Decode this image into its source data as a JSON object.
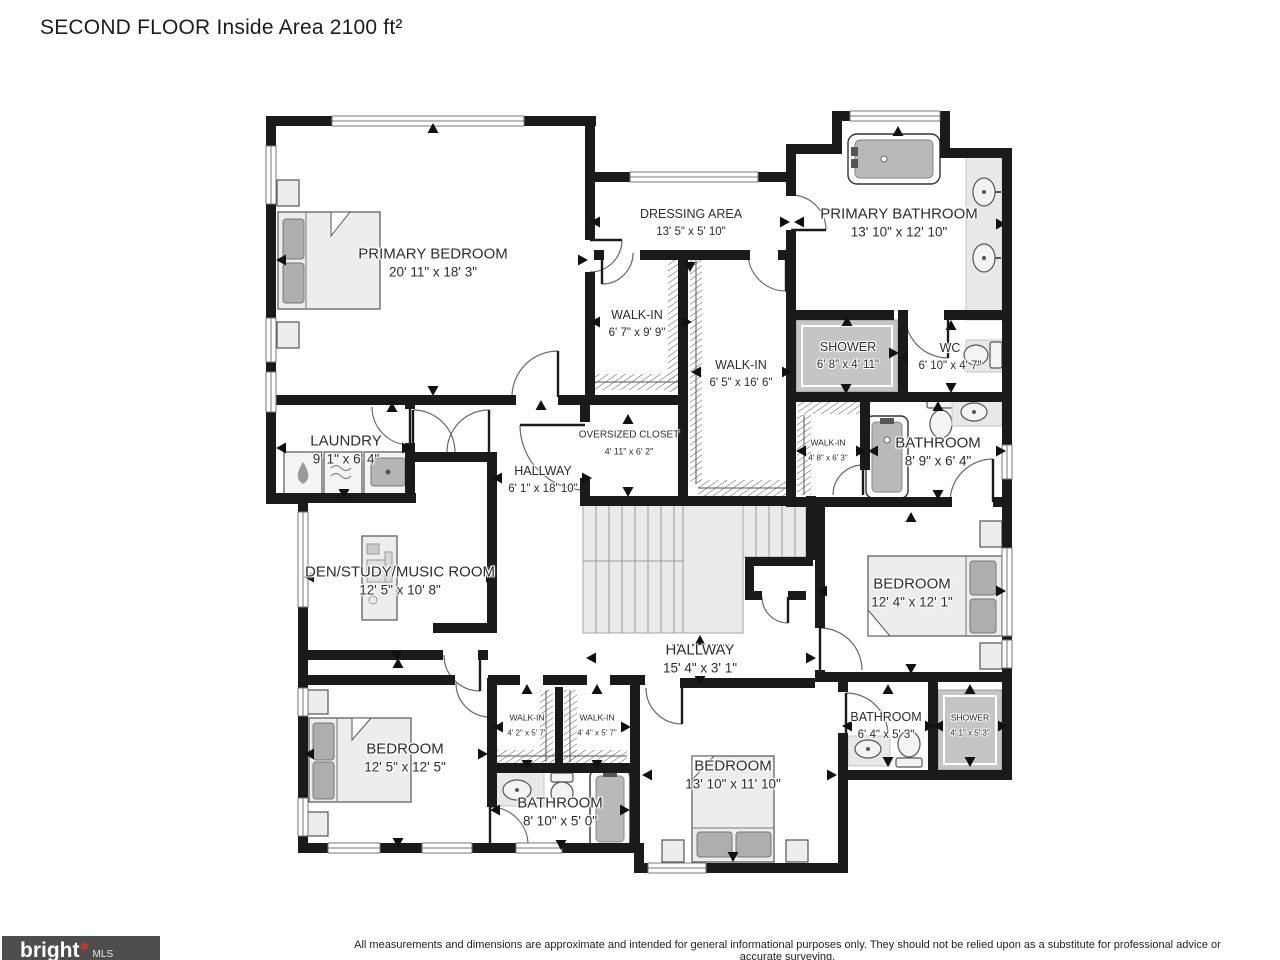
{
  "title": "SECOND FLOOR Inside Area 2100 ft²",
  "rooms": [
    {
      "id": "primary-bedroom",
      "name": "PRIMARY BEDROOM",
      "dims": "20' 11\" x 18' 3\""
    },
    {
      "id": "dressing-area",
      "name": "DRESSING AREA",
      "dims": "13' 5\" x 5' 10\""
    },
    {
      "id": "primary-bathroom",
      "name": "PRIMARY BATHROOM",
      "dims": "13' 10\" x 12' 10\""
    },
    {
      "id": "walk-in-a",
      "name": "WALK-IN",
      "dims": "6' 7\" x 9' 9\""
    },
    {
      "id": "walk-in-b",
      "name": "WALK-IN",
      "dims": "6' 5\" x 16' 6\""
    },
    {
      "id": "shower-primary",
      "name": "SHOWER",
      "dims": "6' 8\" x 4' 11\""
    },
    {
      "id": "wc",
      "name": "WC",
      "dims": "6' 10\" x 4' 7\""
    },
    {
      "id": "laundry",
      "name": "LAUNDRY",
      "dims": "9' 1\" x 6' 4\""
    },
    {
      "id": "hallway-upper",
      "name": "HALLWAY",
      "dims": "6' 1\" x 18' 10\""
    },
    {
      "id": "oversized-closet",
      "name": "OVERSIZED CLOSET",
      "dims": "4' 11\" x 6' 2\""
    },
    {
      "id": "walk-in-c",
      "name": "WALK-IN",
      "dims": "4' 8\" x 6' 3\""
    },
    {
      "id": "bathroom-upper",
      "name": "BATHROOM",
      "dims": "8' 9\" x 6' 4\""
    },
    {
      "id": "bedroom-right",
      "name": "BEDROOM",
      "dims": "12' 4\" x 12' 1\""
    },
    {
      "id": "den-study",
      "name": "DEN/STUDY/MUSIC ROOM",
      "dims": "12' 5\" x 10' 8\""
    },
    {
      "id": "hallway-lower",
      "name": "HALLWAY",
      "dims": "15' 4\" x 3' 1\""
    },
    {
      "id": "bedroom-left",
      "name": "BEDROOM",
      "dims": "12' 5\" x 12' 5\""
    },
    {
      "id": "walk-in-d",
      "name": "WALK-IN",
      "dims": "4' 2\" x 5' 7\""
    },
    {
      "id": "walk-in-e",
      "name": "WALK-IN",
      "dims": "4' 4\" x 5' 7\""
    },
    {
      "id": "bathroom-lower-left",
      "name": "BATHROOM",
      "dims": "8' 10\" x 5' 0\""
    },
    {
      "id": "bedroom-bottom",
      "name": "BEDROOM",
      "dims": "13' 10\" x 11' 10\""
    },
    {
      "id": "bathroom-lower-right",
      "name": "BATHROOM",
      "dims": "6' 4\" x 5' 3\""
    },
    {
      "id": "shower-lower",
      "name": "SHOWER",
      "dims": "4' 1\" x 5' 3\""
    }
  ],
  "footer": {
    "disclaimer": "All measurements and dimensions are approximate and intended for general informational purposes only. They should not be relied upon as a substitute for professional advice or accurate surveying.",
    "brand": "bright",
    "brand_suffix": "MLS"
  },
  "colors": {
    "wall": "#1a1a1a",
    "shaded": "#c5c5c5",
    "furniture": "#ededed",
    "logo_bg": "#4e4e4e",
    "logo_star": "#c0392b"
  }
}
